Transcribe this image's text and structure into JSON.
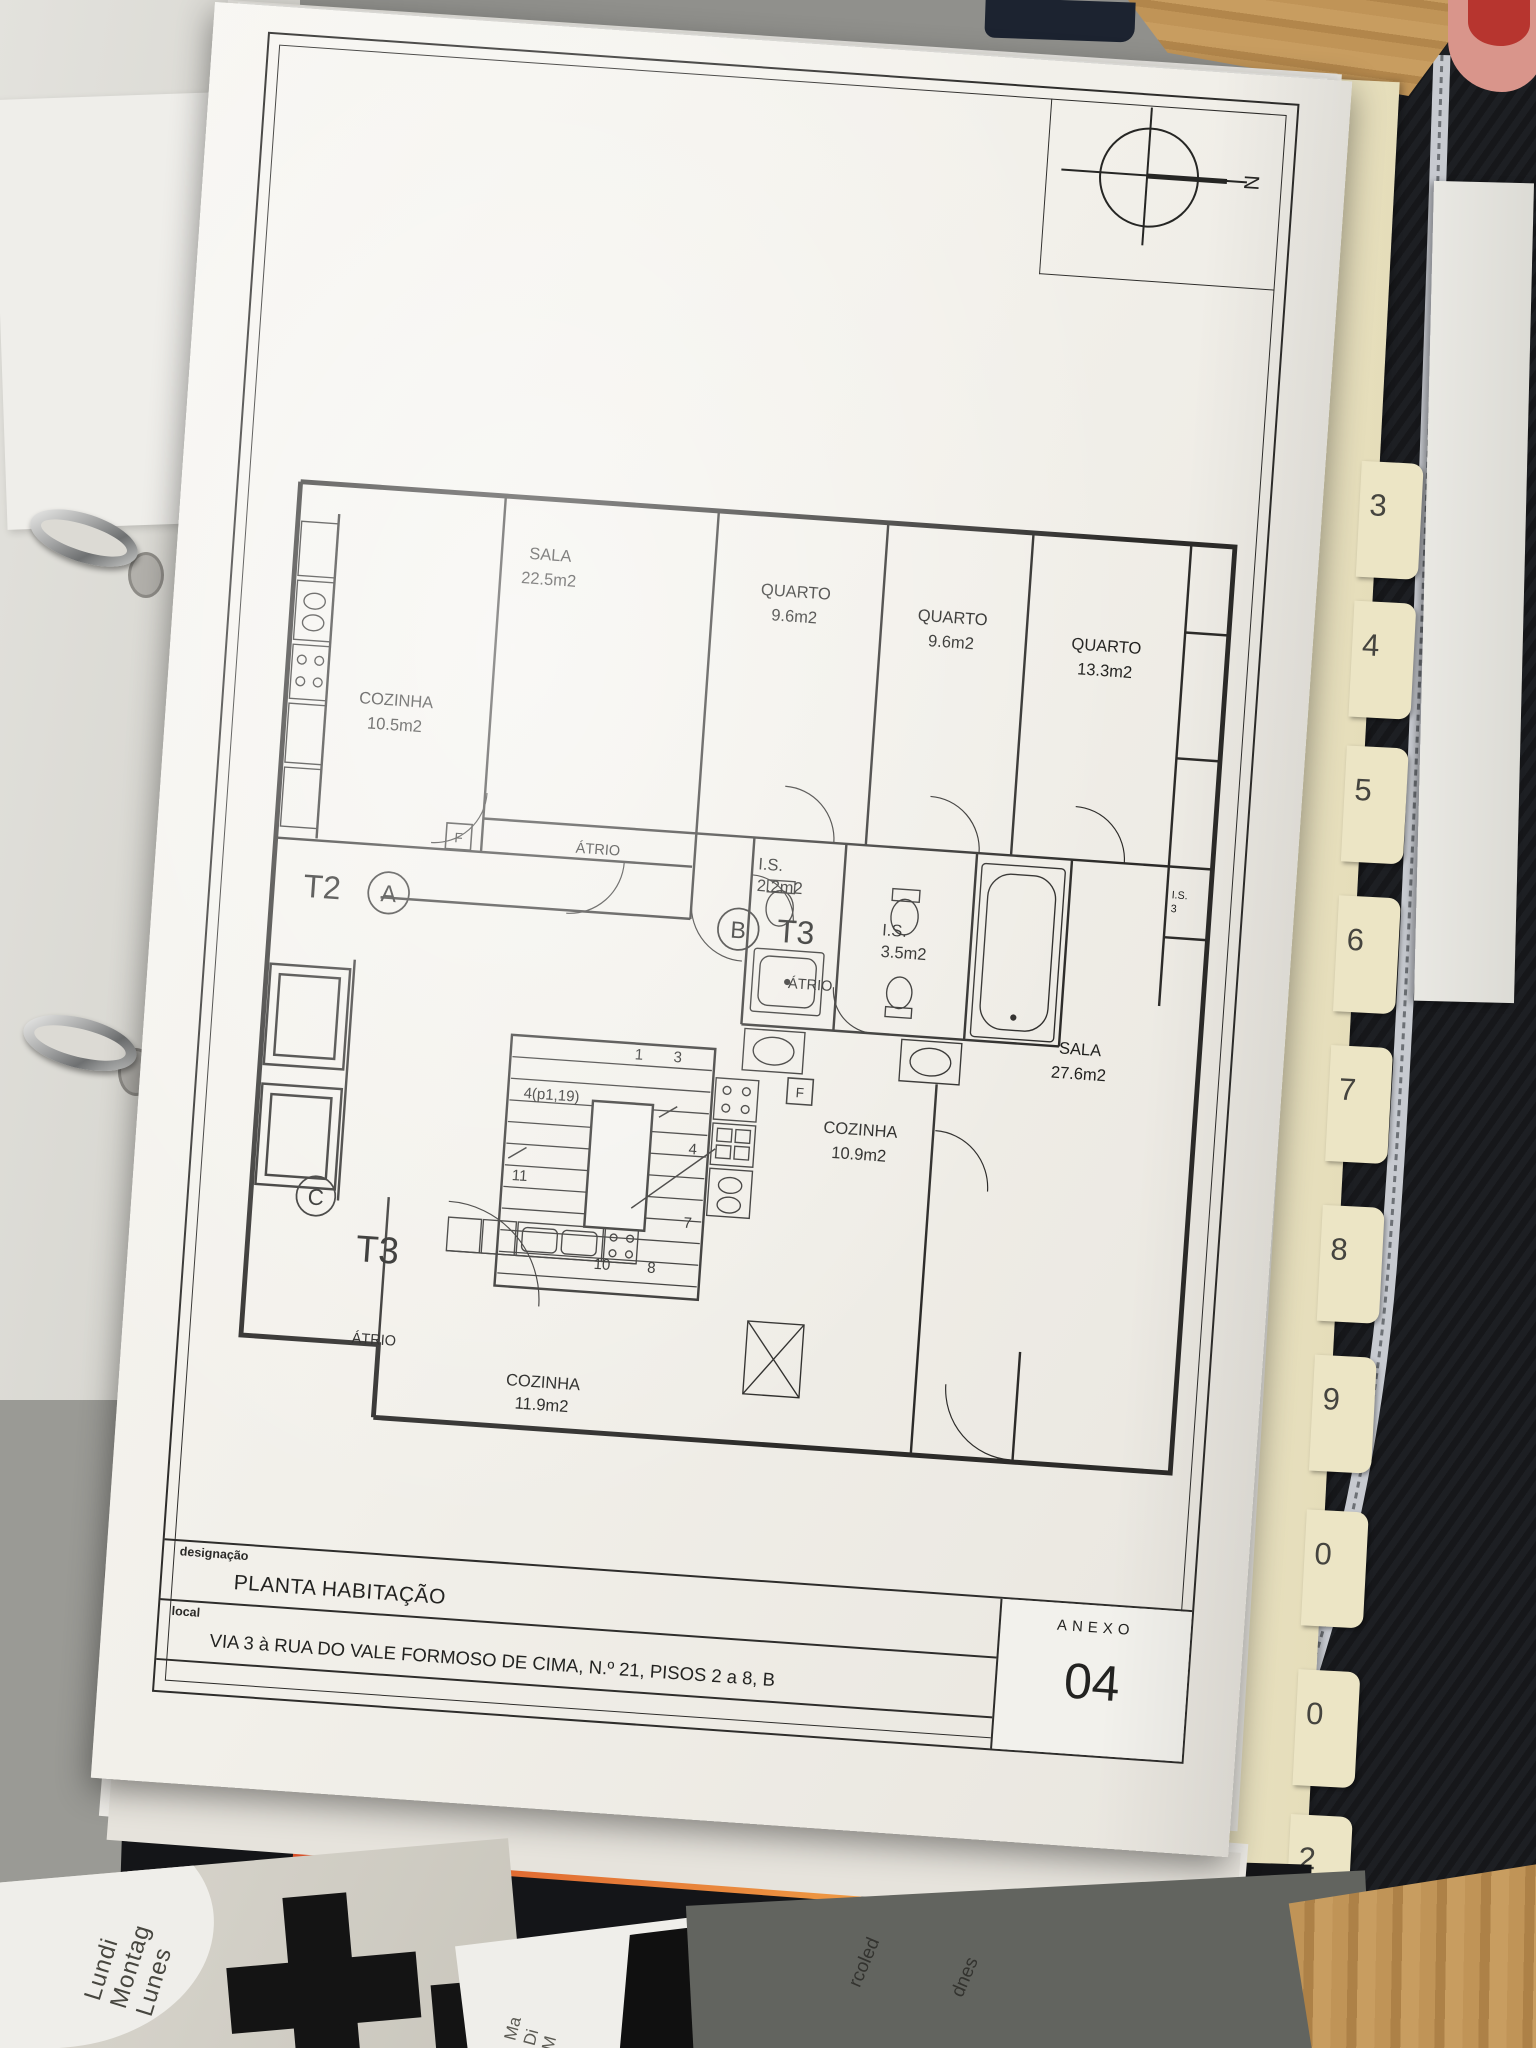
{
  "sheet": {
    "compass_north": "N",
    "plan": {
      "rooms": [
        {
          "name": "SALA",
          "area": "22.5m2"
        },
        {
          "name": "QUARTO",
          "area": "9.6m2"
        },
        {
          "name": "QUARTO",
          "area": "9.6m2"
        },
        {
          "name": "QUARTO",
          "area": "13.3m2"
        },
        {
          "name": "COZINHA",
          "area": "10.5m2"
        },
        {
          "name": "I.S.",
          "area": "2.2m2"
        },
        {
          "name": "I.S.",
          "area": "3.5m2"
        },
        {
          "name": "SALA",
          "area": "27.6m2"
        },
        {
          "name": "COZINHA",
          "area": "10.9m2"
        },
        {
          "name": "COZINHA",
          "area": "11.9m2"
        },
        {
          "name": "I.S.",
          "area": "3"
        }
      ],
      "units": [
        {
          "code": "T2",
          "letter": "A",
          "hall": "ÁTRIO"
        },
        {
          "code": "T3",
          "letter": "B",
          "hall": "ÁTRIO"
        },
        {
          "code": "T3",
          "letter": "C",
          "hall": "ÁTRIO"
        }
      ],
      "stair_marks": [
        "1",
        "3",
        "4(p1,19)",
        "4",
        "11",
        "7",
        "10",
        "8"
      ],
      "appliance_marks": [
        "F",
        "F"
      ]
    },
    "title_block": {
      "designacao_label": "designação",
      "designacao_value": "PLANTA HABITAÇÃO",
      "local_label": "local",
      "local_value": "VIA 3 à RUA DO VALE FORMOSO DE CIMA, N.º 21, PISOS 2 a 8, B",
      "anexo_label": "ANEXO",
      "anexo_number": "04"
    }
  },
  "binder": {
    "tabs": [
      {
        "label": "3"
      },
      {
        "label": "4"
      },
      {
        "label": "5"
      },
      {
        "label": "6"
      },
      {
        "label": "7"
      },
      {
        "label": "8"
      },
      {
        "label": "9"
      },
      {
        "label": "0"
      },
      {
        "label": "0"
      },
      {
        "label": "2"
      }
    ]
  },
  "desk": {
    "planner_text": [
      "Lundi",
      "Montag",
      "Lunes"
    ],
    "planner_fragments": [
      "Ma",
      "Di",
      "M"
    ],
    "book_fragments": [
      "rcoled",
      "dnes"
    ]
  }
}
